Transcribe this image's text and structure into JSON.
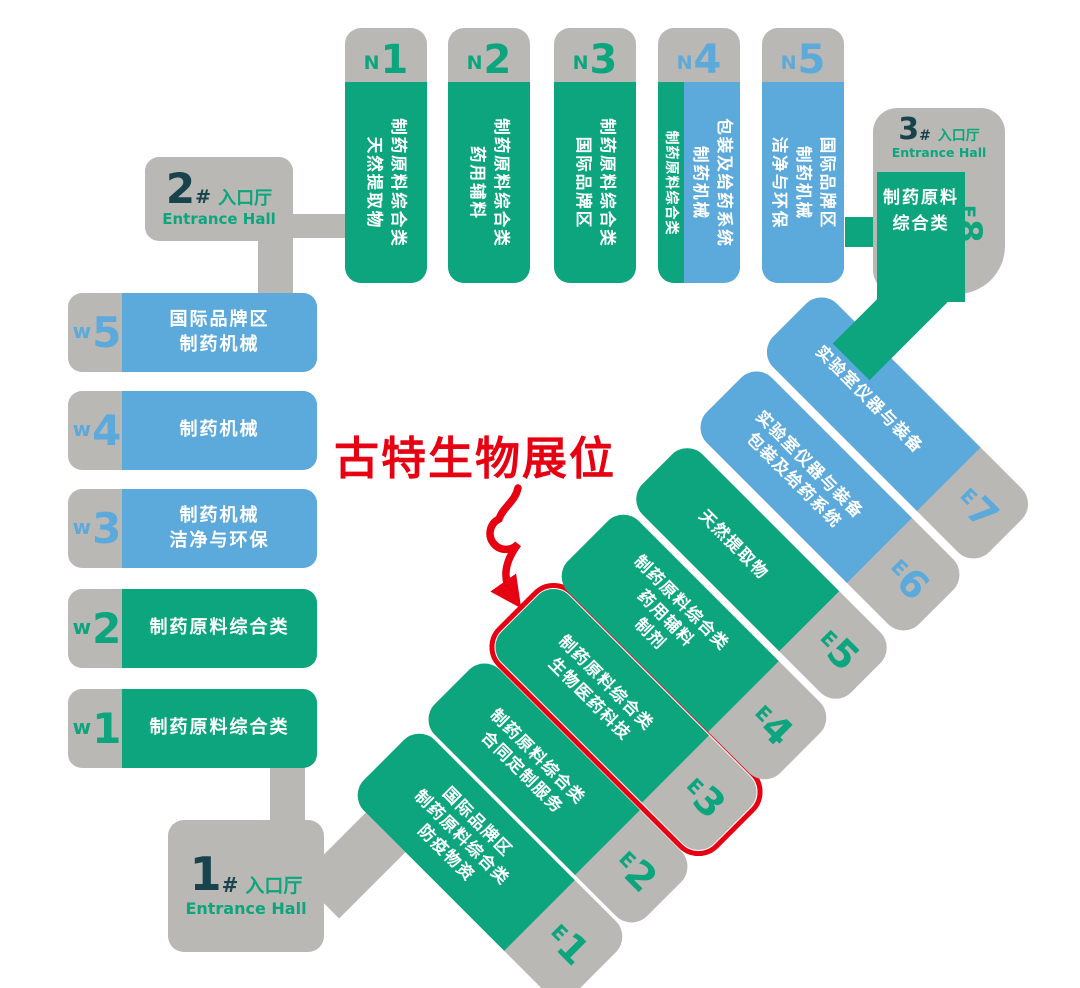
{
  "annotation": {
    "label": "古特生物展位",
    "arrow_icon": "curved-loop-arrow-down",
    "highlight_target": "E3"
  },
  "colors": {
    "green": "#0CA57D",
    "blue": "#5CA9DC",
    "grey": "#B9B8B5",
    "red": "#E60012",
    "dark_number": "#18434C",
    "text_on_block": "#FFFFFF"
  },
  "entrances": [
    {
      "number": "1",
      "hash": "#",
      "zh": "入口厅",
      "en": "Entrance Hall"
    },
    {
      "number": "2",
      "hash": "#",
      "zh": "入口厅",
      "en": "Entrance Hall"
    },
    {
      "number": "3",
      "hash": "#",
      "zh": "入口厅",
      "en": "Entrance Hall"
    }
  ],
  "north_halls": [
    {
      "letter": "N",
      "digit": "1",
      "lines": [
        "制药原料综合类",
        "天然提取物"
      ]
    },
    {
      "letter": "N",
      "digit": "2",
      "lines": [
        "制药原料综合类",
        "药用辅料"
      ]
    },
    {
      "letter": "N",
      "digit": "3",
      "lines": [
        "制药原料综合类",
        "国际品牌区"
      ]
    },
    {
      "letter": "N",
      "digit": "4",
      "strip_lines": [
        "制药原料综合类"
      ],
      "lines": [
        "包装及给药系统",
        "制药机械"
      ]
    },
    {
      "letter": "N",
      "digit": "5",
      "lines": [
        "国际品牌区",
        "制药机械",
        "洁净与环保"
      ]
    }
  ],
  "west_halls": [
    {
      "letter": "w",
      "digit": "5",
      "lines": [
        "国际品牌区",
        "制药机械"
      ]
    },
    {
      "letter": "w",
      "digit": "4",
      "lines": [
        "制药机械"
      ]
    },
    {
      "letter": "w",
      "digit": "3",
      "lines": [
        "制药机械",
        "洁净与环保"
      ]
    },
    {
      "letter": "w",
      "digit": "2",
      "lines": [
        "制药原料综合类"
      ]
    },
    {
      "letter": "w",
      "digit": "1",
      "lines": [
        "制药原料综合类"
      ]
    }
  ],
  "east_halls": [
    {
      "letter": "E",
      "digit": "1",
      "lines": [
        "国际品牌区",
        "制药原料综合类",
        "防疫物资"
      ]
    },
    {
      "letter": "E",
      "digit": "2",
      "lines": [
        "制药原料综合类",
        "合同定制服务"
      ]
    },
    {
      "letter": "E",
      "digit": "3",
      "lines": [
        "制药原料综合类",
        "生物医药科技"
      ],
      "highlighted": true
    },
    {
      "letter": "E",
      "digit": "4",
      "lines": [
        "制药原料综合类",
        "药用辅料",
        "制剂"
      ]
    },
    {
      "letter": "E",
      "digit": "5",
      "lines": [
        "天然提取物"
      ]
    },
    {
      "letter": "E",
      "digit": "6",
      "lines": [
        "实验室仪器与装备",
        "包装及给药系统"
      ]
    },
    {
      "letter": "E",
      "digit": "7",
      "lines": [
        "实验室仪器与装备"
      ]
    },
    {
      "letter": "E",
      "digit": "8",
      "lines": [
        "制药原料",
        "综合类"
      ]
    }
  ]
}
